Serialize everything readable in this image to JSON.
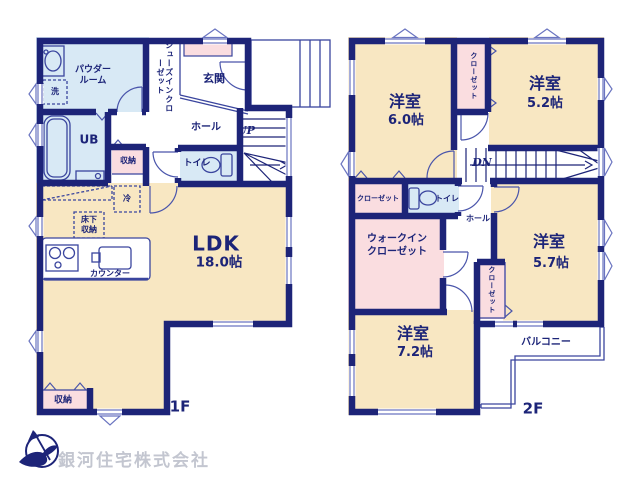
{
  "floor1": {
    "name": "1F",
    "labels": {
      "powder_l1": "パウダー",
      "powder_l2": "ルーム",
      "wash": "洗",
      "shoes_closet": "シューズインクローゼット",
      "entrance": "玄関",
      "hall": "ホール",
      "up": "UP",
      "bath": "UB",
      "storage_hall": "収納",
      "toilet": "トイレ",
      "fridge": "冷",
      "underfloor_l1": "床下",
      "underfloor_l2": "収納",
      "counter": "カウンター",
      "ldk": "LDK",
      "ldk_size": "18.0帖",
      "storage_bottom": "収納"
    }
  },
  "floor2": {
    "name": "2F",
    "labels": {
      "room_a": "洋室",
      "room_a_size": "6.0帖",
      "closet_top": "クローゼット",
      "room_b": "洋室",
      "room_b_size": "5.2帖",
      "dn": "DN",
      "closet_left": "クローゼット",
      "toilet": "トイレ",
      "hall": "ホール",
      "wic_l1": "ウォークイン",
      "wic_l2": "クローゼット",
      "room_c": "洋室",
      "room_c_size": "5.7帖",
      "closet_mid": "クローゼット",
      "room_d": "洋室",
      "room_d_size": "7.2帖",
      "balcony": "バルコニー"
    }
  },
  "company": "銀河住宅株式会社",
  "colors": {
    "wall": "#1d2478",
    "line": "#3a459e",
    "room_cream": "#f8e7c2",
    "closet_pink": "#fadde0",
    "wet_blue": "#d8e9f5",
    "text_navy": "#1c2478",
    "company_gray": "#c3c6d0"
  }
}
